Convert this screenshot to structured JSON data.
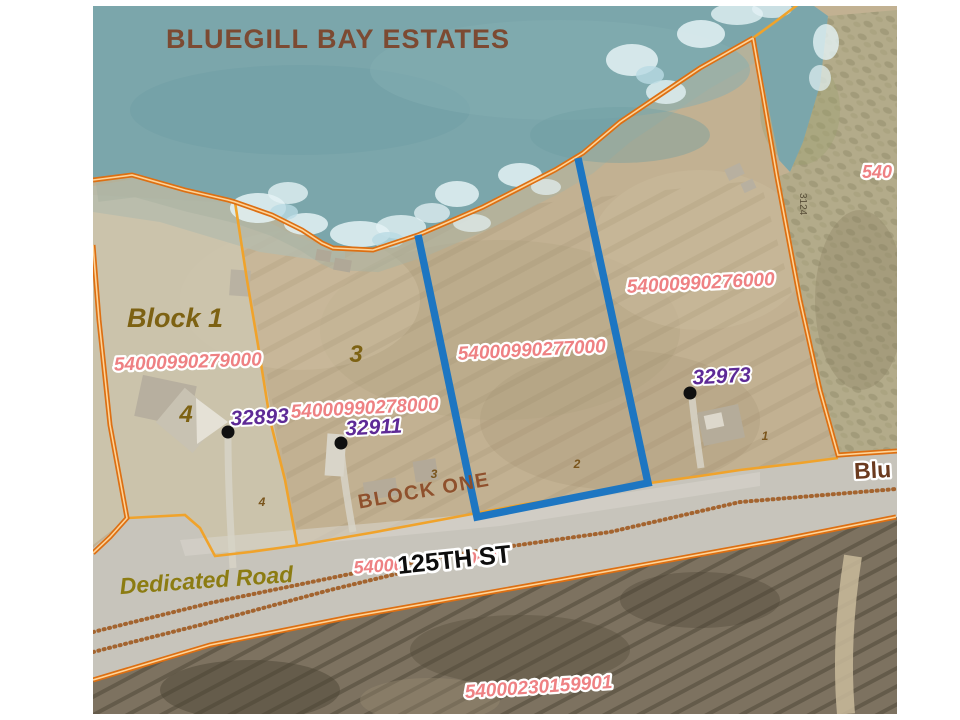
{
  "map_title": "BLUEGILL BAY ESTATES",
  "subdivision": {
    "block_label": "Block 1",
    "block_one_label": "BLOCK ONE",
    "large_lot_numbers": [
      "4",
      "3"
    ],
    "small_lot_numbers": [
      "4",
      "3",
      "2",
      "1"
    ]
  },
  "roads": {
    "street_125th": "125TH ST",
    "street_bluegill_partial": "Blu",
    "dedicated_road_label": "Dedicated Road"
  },
  "parcels": {
    "block1_west": "54000990279000",
    "lot3": "54000990278000",
    "selected": "54000990277000",
    "lot1_east": "54000990276000",
    "south_of_road": "54000230159901",
    "hidden_behind_street_left": "54000",
    "hidden_behind_street_right": "000",
    "right_edge_partial": "540"
  },
  "addresses": [
    "32893",
    "32911",
    "32973"
  ],
  "annotations": {
    "survey_number_vertical": "3124"
  },
  "colors": {
    "water": "#7ba6ab",
    "parcel_label": "#ee8183",
    "address_label": "#5e2a96",
    "boundary_orange": "#dd6f12",
    "lot_line_yellow": "#f0a32b",
    "selected_parcel_blue": "#1d76c2"
  }
}
